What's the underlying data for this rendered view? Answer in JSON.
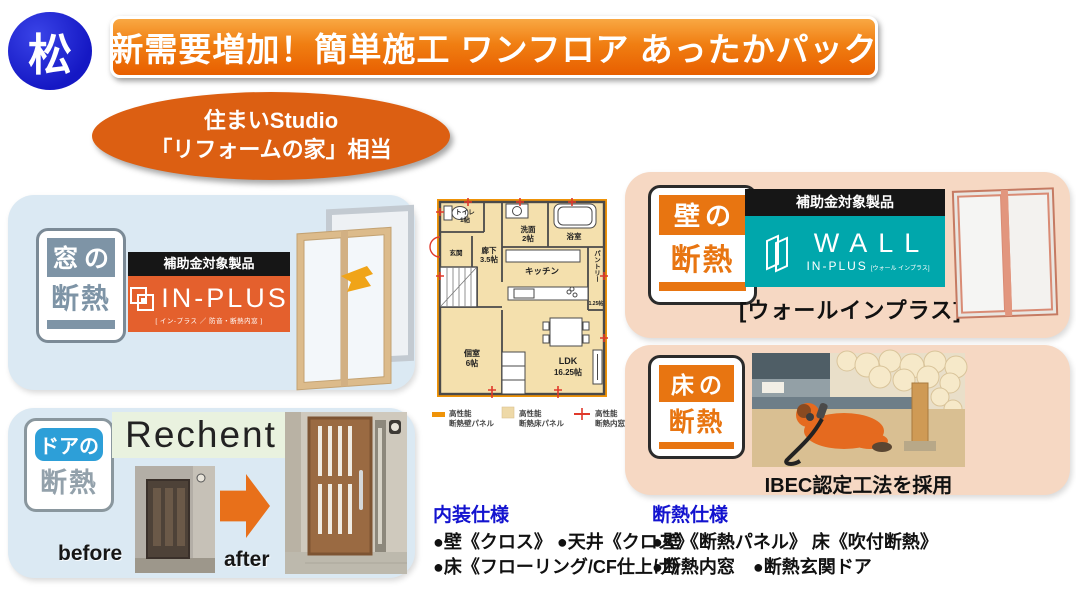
{
  "header": {
    "grade_label": "松",
    "banner_title": "新需要増加！簡単施工 ワンフロア あったかパック",
    "oval_line1": "住まいStudio",
    "oval_line2": "「リフォームの家」相当"
  },
  "window_section": {
    "badge_top": "窓の",
    "badge_bottom": "断熱",
    "subsidy_label": "補助金対象製品",
    "brand": "IN-PLUS",
    "brand_sub": "[ イン-プラス ／ 防音・断熱内窓 ]"
  },
  "door_section": {
    "badge_top": "ドアの",
    "badge_bottom": "断熱",
    "brand": "Rechent",
    "before_label": "before",
    "after_label": "after"
  },
  "wall_section": {
    "badge_top": "壁の",
    "badge_bottom": "断熱",
    "subsidy_label": "補助金対象製品",
    "brand": "WALL",
    "brand_sub": "IN-PLUS",
    "brand_small": "[ウォール インプラス]",
    "caption": "[ウォールインプラス]"
  },
  "floor_section": {
    "badge_top": "床の",
    "badge_bottom": "断熱",
    "caption": "IBEC認定工法を採用"
  },
  "floorplan": {
    "rooms": {
      "toilet": "トイレ",
      "toilet_size": "1帖",
      "entrance": "玄関",
      "hallway": "廊下",
      "hallway_size": "3.5帖",
      "washroom": "洗面",
      "washroom_size": "2帖",
      "bathroom": "浴室",
      "kitchen": "キッチン",
      "pantry": "パントリー",
      "pantry_size": "1.25帖",
      "private_room": "個室",
      "private_room_size": "6帖",
      "ldk": "LDK",
      "ldk_size": "16.25帖"
    },
    "legend": {
      "wall_panel_1": "高性能",
      "wall_panel_2": "断熱壁パネル",
      "floor_panel_1": "高性能",
      "floor_panel_2": "断熱床パネル",
      "inner_window_1": "高性能",
      "inner_window_2": "断熱内窓"
    }
  },
  "specs": {
    "interior_title": "内装仕様",
    "interior_line1": "●壁《クロス》 ●天井《クロス》",
    "interior_line2": "●床《フローリング/CF仕上げ》",
    "insulation_title": "断熱仕様",
    "insulation_line1": "●壁《断熱パネル》 床《吹付断熱》",
    "insulation_line2": "●断熱内窓　●断熱玄関ドア"
  },
  "colors": {
    "banner_orange": "#ee7203",
    "grade_blue": "#1518c4",
    "oval_orange": "#dc5f12",
    "badge_gray_blue": "#7e94a6",
    "badge_door_blue": "#2d9fd8",
    "badge_orange": "#e87511",
    "inplus_orange": "#e4602d",
    "wall_teal": "#00a7ac",
    "panel_blue": "#dbe9f3",
    "panel_peach": "#f6d8c3",
    "spec_title_blue": "#1313cf"
  }
}
